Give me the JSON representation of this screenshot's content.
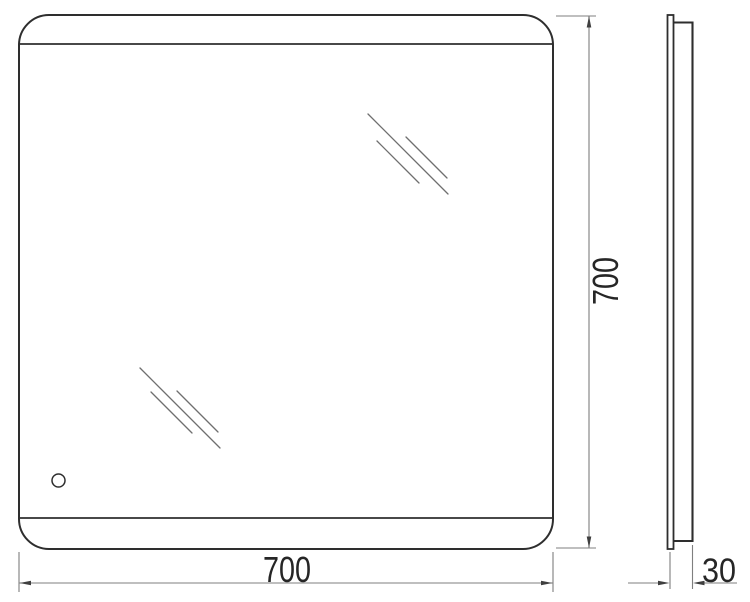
{
  "colors": {
    "background": "#ffffff",
    "outline": "#2e2e2e",
    "hatch_line": "#6f6f6f",
    "dimension_line": "#7f7f7f",
    "arrow": "#3f3f3f",
    "text": "#262626"
  },
  "dimensions": {
    "width": "700",
    "height": "700",
    "depth": "30"
  }
}
